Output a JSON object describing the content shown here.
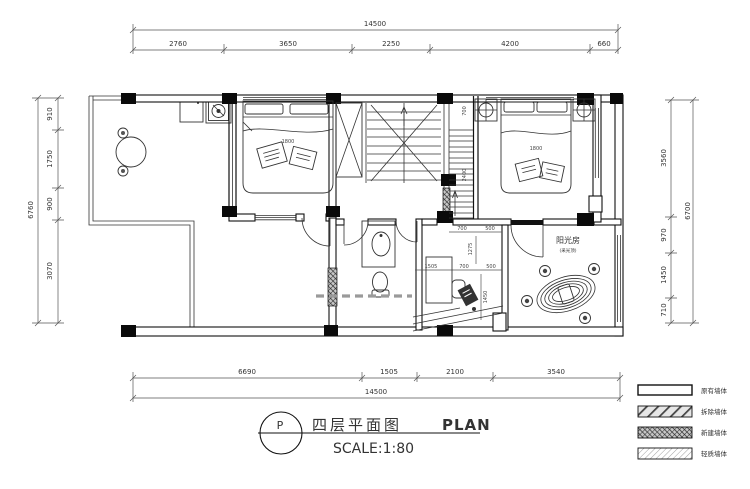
{
  "drawing": {
    "marker": "P",
    "title_cn": "四层平面图",
    "title_en": "PLAN",
    "scale_label": "SCALE:1:80"
  },
  "dims": {
    "top": {
      "overall": "14500",
      "segments": [
        "2760",
        "3650",
        "2250",
        "4200",
        "660"
      ]
    },
    "bottom": {
      "overall": "14500",
      "segments": [
        "6690",
        "1505",
        "2100",
        "3540"
      ]
    },
    "left": {
      "overall": "6760",
      "segments": [
        "910",
        "1750",
        "900",
        "3070"
      ]
    },
    "right": {
      "overall": "6700",
      "segments": [
        "3560",
        "970",
        "1450",
        "710"
      ]
    }
  },
  "interior_dims": {
    "stair_width": "700",
    "stair_run": "2400",
    "nook_top_a": "700",
    "nook_top_b": "500",
    "nook_rot_a": "1275",
    "nook_mid_a": "1505",
    "nook_mid_b": "700",
    "nook_mid_c": "500",
    "nook_rot_b": "1450",
    "bed1_width": "1800",
    "bed2_width": "1800"
  },
  "rooms": {
    "sunroom": "阳光房",
    "sunroom_note": "(采光顶)"
  },
  "legend": {
    "items": [
      {
        "label": "原有墙体",
        "style": "existing"
      },
      {
        "label": "拆除墙体",
        "style": "demolish"
      },
      {
        "label": "新建墙体",
        "style": "new"
      },
      {
        "label": "轻质墙体",
        "style": "light"
      }
    ]
  },
  "colors": {
    "line": "#111111",
    "dim": "#555555",
    "demolition_dash": "#9a9a9a"
  }
}
